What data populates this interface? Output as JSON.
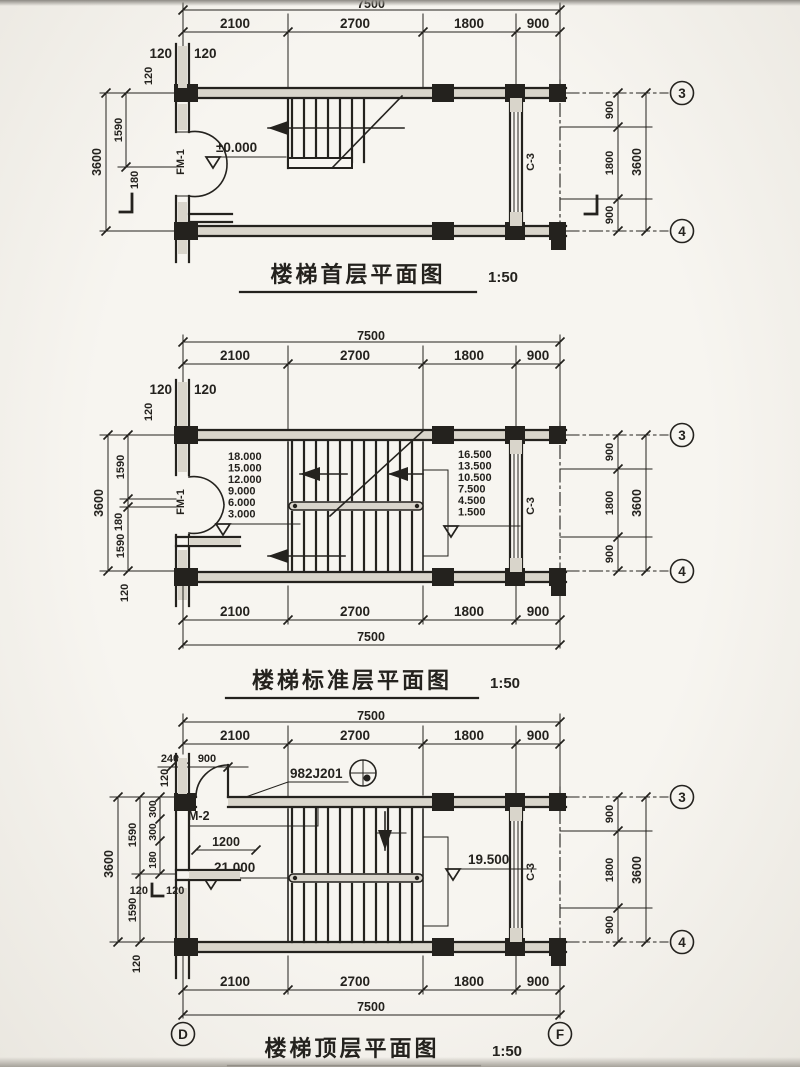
{
  "p1": {
    "title": "楼梯首层平面图",
    "scale": "1:50",
    "top_total": "7500",
    "top_segs": [
      "2100",
      "2700",
      "1800",
      "900"
    ],
    "w120a": "120",
    "w120b": "120",
    "w120v": "120",
    "l1590": "1590",
    "l180": "180",
    "l3600": "3600",
    "r_segs": [
      "900",
      "1800",
      "900"
    ],
    "r_total": "3600",
    "ax3": "3",
    "ax4": "4",
    "door": "FM-1",
    "window": "C-3",
    "level": "±0.000"
  },
  "p2": {
    "title": "楼梯标准层平面图",
    "scale": "1:50",
    "top_total": "7500",
    "top_segs": [
      "2100",
      "2700",
      "1800",
      "900"
    ],
    "bottom_total": "7500",
    "bottom_segs": [
      "2100",
      "2700",
      "1800",
      "900"
    ],
    "w120a": "120",
    "w120b": "120",
    "w120v": "120",
    "w120bot": "120",
    "l1590a": "1590",
    "l180": "180",
    "l1590b": "1590",
    "l3600": "3600",
    "levels_left": [
      "18.000",
      "15.000",
      "12.000",
      "9.000",
      "6.000",
      "3.000"
    ],
    "levels_right": [
      "16.500",
      "13.500",
      "10.500",
      "7.500",
      "4.500",
      "1.500"
    ],
    "r_segs": [
      "900",
      "1800",
      "900"
    ],
    "r_total": "3600",
    "ax3": "3",
    "ax4": "4",
    "door": "FM-1",
    "window": "C-3"
  },
  "p3": {
    "title": "楼梯顶层平面图",
    "scale": "1:50",
    "top_total": "7500",
    "top_segs": [
      "2100",
      "2700",
      "1800",
      "900"
    ],
    "bottom_total": "7500",
    "bottom_segs": [
      "2100",
      "2700",
      "1800",
      "900"
    ],
    "d240": "240",
    "d900": "900",
    "d1200": "1200",
    "detail_ref": "982J201",
    "door": "M-2",
    "level_left": "21.000",
    "level_right": "19.500",
    "w120v_top": "120",
    "w120v_bot": "120",
    "w120ma": "120",
    "w120mb": "120",
    "l1590a": "1590",
    "l1590b": "1590",
    "l300a": "300",
    "l300b": "300",
    "l180": "180",
    "l3600": "3600",
    "r_segs": [
      "900",
      "1800",
      "900"
    ],
    "r_total": "3600",
    "ax3": "3",
    "ax4": "4",
    "axD": "D",
    "axF": "F",
    "window": "C-3"
  }
}
